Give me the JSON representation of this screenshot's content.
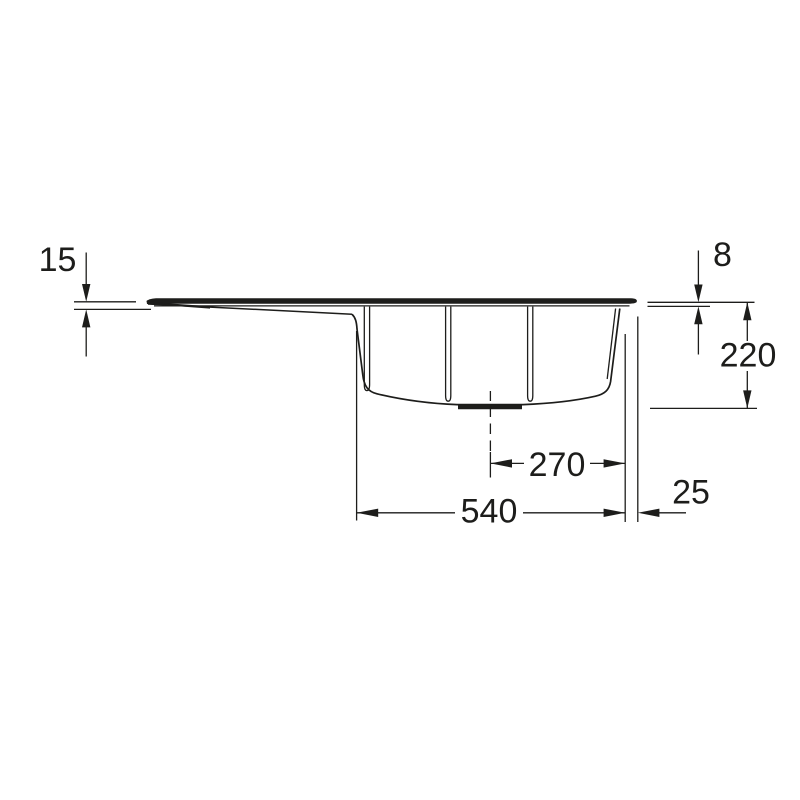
{
  "colors": {
    "background": "#ffffff",
    "line": "#1d1d1b",
    "text": "#1d1d1b"
  },
  "drawing": {
    "type": "technical-section-drawing",
    "subject": "sink-side-section",
    "dimensions": {
      "left_edge_height": "15",
      "rim_thickness": "8",
      "bowl_depth": "220",
      "center_to_right_edge": "270",
      "bowl_width": "540",
      "right_overhang": "25"
    }
  }
}
